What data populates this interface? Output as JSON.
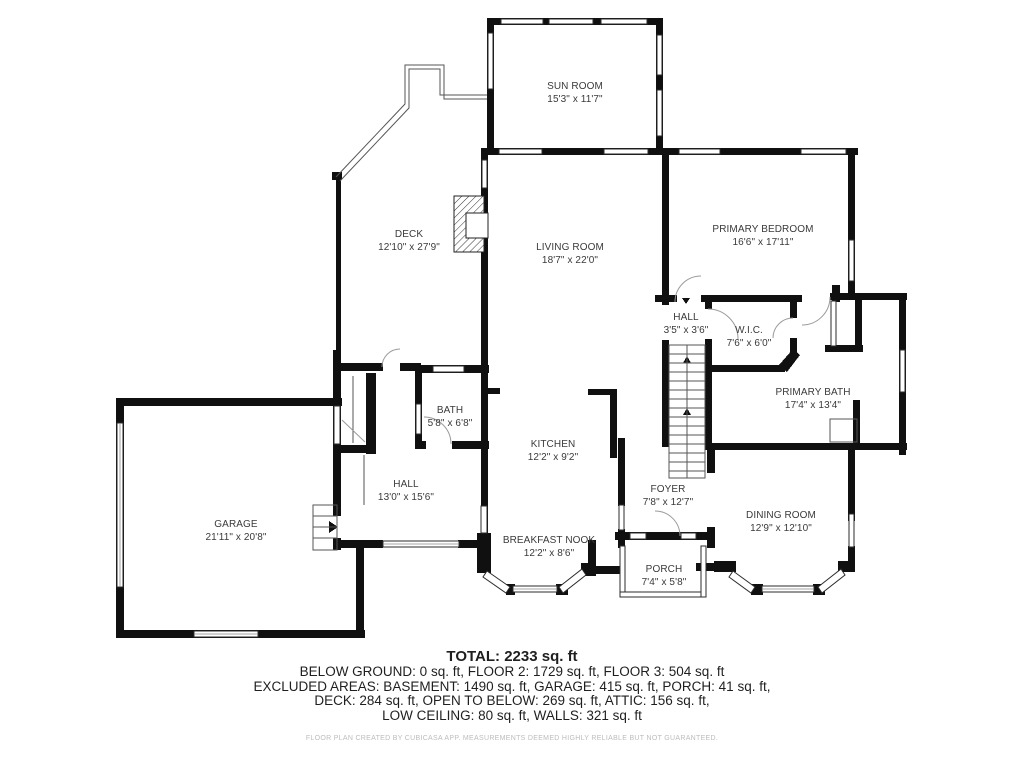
{
  "plan": {
    "rooms": [
      {
        "id": "sun-room",
        "name": "SUN ROOM",
        "dims": "15'3\" x 11'7\""
      },
      {
        "id": "deck",
        "name": "DECK",
        "dims": "12'10\" x 27'9\""
      },
      {
        "id": "living-room",
        "name": "LIVING ROOM",
        "dims": "18'7\" x 22'0\""
      },
      {
        "id": "primary-bedroom",
        "name": "PRIMARY BEDROOM",
        "dims": "16'6\" x 17'11\""
      },
      {
        "id": "hall-upper",
        "name": "HALL",
        "dims": "3'5\" x 3'6\""
      },
      {
        "id": "wic",
        "name": "W.I.C.",
        "dims": "7'6\" x 6'0\""
      },
      {
        "id": "primary-bath",
        "name": "PRIMARY BATH",
        "dims": "17'4\" x 13'4\""
      },
      {
        "id": "bath",
        "name": "BATH",
        "dims": "5'8\" x 6'8\""
      },
      {
        "id": "kitchen",
        "name": "KITCHEN",
        "dims": "12'2\" x 9'2\""
      },
      {
        "id": "hall-lower",
        "name": "HALL",
        "dims": "13'0\" x 15'6\""
      },
      {
        "id": "foyer",
        "name": "FOYER",
        "dims": "7'8\" x 12'7\""
      },
      {
        "id": "dining-room",
        "name": "DINING ROOM",
        "dims": "12'9\" x 12'10\""
      },
      {
        "id": "garage",
        "name": "GARAGE",
        "dims": "21'11\" x 20'8\""
      },
      {
        "id": "breakfast-nook",
        "name": "BREAKFAST NOOK",
        "dims": "12'2\" x 8'6\""
      },
      {
        "id": "porch",
        "name": "PORCH",
        "dims": "7'4\" x 5'8\""
      }
    ]
  },
  "summary": {
    "total": "TOTAL: 2233 sq. ft",
    "line1": "BELOW GROUND: 0 sq. ft, FLOOR 2: 1729 sq. ft, FLOOR 3: 504 sq. ft",
    "line2": "EXCLUDED AREAS: BASEMENT: 1490 sq. ft, GARAGE: 415 sq. ft, PORCH: 41 sq. ft,",
    "line3": "DECK: 284 sq. ft, OPEN TO BELOW: 269 sq. ft, ATTIC: 156 sq. ft,",
    "line4": "LOW CEILING: 80 sq. ft, WALLS: 321 sq. ft",
    "disclaimer": "FLOOR PLAN CREATED BY CUBICASA APP. MEASUREMENTS DEEMED HIGHLY RELIABLE BUT NOT GUARANTEED."
  },
  "colors": {
    "wall": "#101010",
    "label": "#3a3a3a",
    "summary": "#1f1f1f",
    "disclaimer": "#bcbcbc"
  }
}
